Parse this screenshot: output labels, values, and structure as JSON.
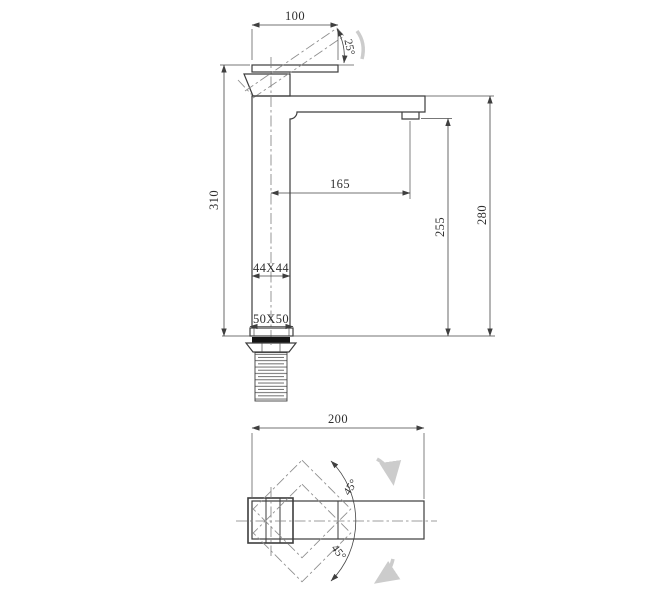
{
  "drawing": {
    "type": "technical-drawing",
    "subject": "tall single-lever basin mixer faucet, dimensioned 2-view drawing",
    "line_color": "#3d3d3d",
    "centerline_color": "#7d7d7d",
    "rotation_arrow_color": "#cccccc",
    "gasket_fill": "#141414",
    "side_view": {
      "dim_handle_length": "100",
      "dim_handle_angle": "25°",
      "dim_total_height": "310",
      "dim_spout_reach": "165",
      "dim_spout_underside_height": "255",
      "dim_spout_top_height": "280",
      "dim_body_section": "44X44",
      "dim_base_section": "50X50"
    },
    "top_view": {
      "dim_overall_length": "200",
      "dim_swing_upper": "45°",
      "dim_swing_lower": "45°"
    }
  }
}
